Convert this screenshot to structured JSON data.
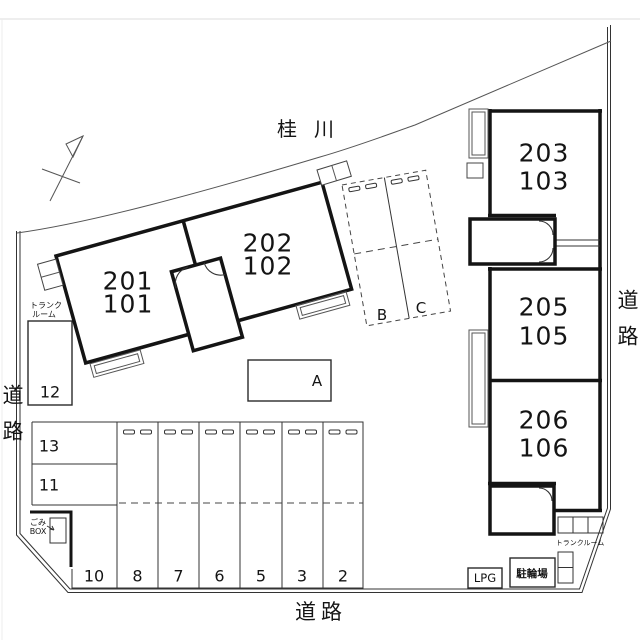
{
  "map": {
    "river_label": "桂川",
    "roads": {
      "left": "道路",
      "right": "道路",
      "bottom": "道路"
    },
    "units": {
      "u201": {
        "upper": "201",
        "lower": "101"
      },
      "u202": {
        "upper": "202",
        "lower": "102"
      },
      "u203": {
        "upper": "203",
        "lower": "103"
      },
      "u205": {
        "upper": "205",
        "lower": "105"
      },
      "u206": {
        "upper": "206",
        "lower": "106"
      }
    },
    "parking": {
      "space_12": "12",
      "space_13": "13",
      "space_11": "11",
      "row": [
        "10",
        "8",
        "7",
        "6",
        "5",
        "3",
        "2"
      ],
      "space_b": "B",
      "space_c": "C",
      "space_a": "A"
    },
    "facilities": {
      "trunk_left_line1": "トランク",
      "trunk_left_line2": "ルーム",
      "trunk_right": "トランクルーム",
      "garbage_line1": "ごみ",
      "garbage_line2": "BOX",
      "lpg": "LPG",
      "bicycle": "駐輪場"
    },
    "colors": {
      "wall": "#141414",
      "line": "#333333",
      "background": "#ffffff"
    }
  }
}
